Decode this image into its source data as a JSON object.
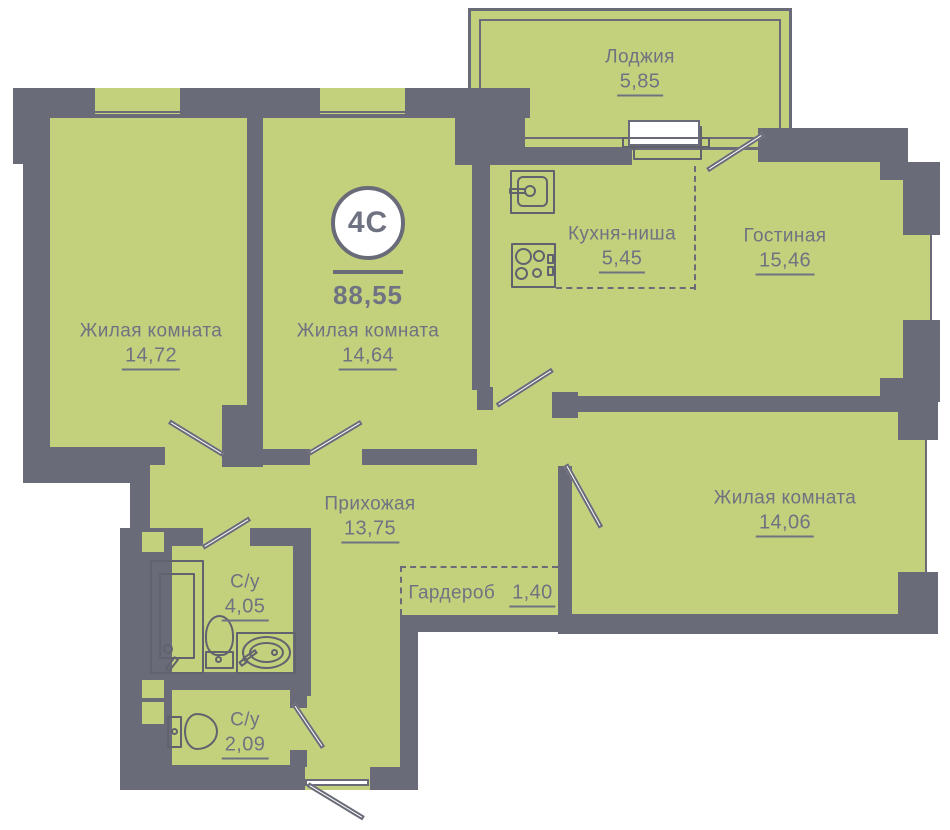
{
  "plan": {
    "type_badge": {
      "label": "4С",
      "total_area": "88,55"
    },
    "rooms": [
      {
        "key": "loggia",
        "name": "Лоджия",
        "area": "5,85"
      },
      {
        "key": "kitchen-niche",
        "name": "Кухня-ниша",
        "area": "5,45"
      },
      {
        "key": "living-room",
        "name": "Гостиная",
        "area": "15,46"
      },
      {
        "key": "bedroom-1",
        "name": "Жилая комната",
        "area": "14,72"
      },
      {
        "key": "bedroom-2",
        "name": "Жилая комната",
        "area": "14,64"
      },
      {
        "key": "bedroom-3",
        "name": "Жилая комната",
        "area": "14,06"
      },
      {
        "key": "hallway",
        "name": "Прихожая",
        "area": "13,75"
      },
      {
        "key": "wardrobe",
        "name": "Гардероб",
        "area": "1,40"
      },
      {
        "key": "bathroom",
        "name": "С/у",
        "area": "4,05"
      },
      {
        "key": "toilet-room",
        "name": "С/у",
        "area": "2,09"
      }
    ],
    "fixtures": [
      "bathtub",
      "toilet",
      "washbasin",
      "kitchen-sink",
      "stove",
      "loggia-appliance"
    ],
    "colors": {
      "room_fill": "#c3d17d",
      "wall": "#696c78",
      "text": "#6f7280",
      "fixture_line": "#60636e",
      "background": "#ffffff"
    }
  }
}
